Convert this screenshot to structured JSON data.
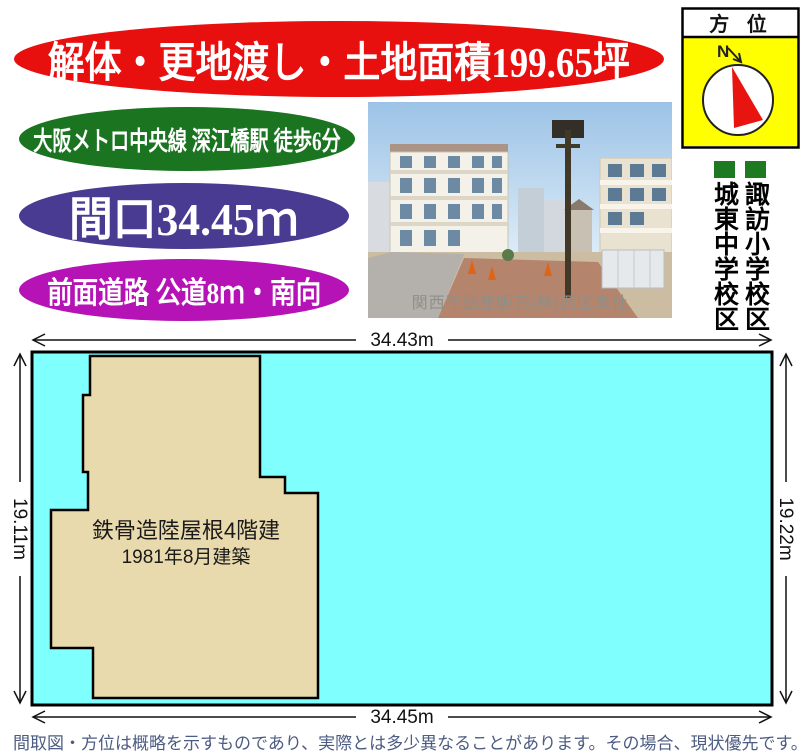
{
  "banners": {
    "main": {
      "label": "解体・更地渡し・土地面積199.65坪",
      "bg": "#e80f0f"
    },
    "access": {
      "label": "大阪メトロ中央線 深江橋駅 徒歩6分",
      "bg": "#1a7420"
    },
    "frontage": {
      "label": "間口34.45ｍ",
      "bg": "#483b91"
    },
    "road": {
      "label": "前面道路 公道8ｍ・南向",
      "bg": "#b513b5"
    }
  },
  "compass": {
    "title": "方 位",
    "north_label": "N",
    "bg": "#ffff00"
  },
  "schools": {
    "junior_high": {
      "label": "城東中学校区"
    },
    "elementary": {
      "label": "諏訪小学校区"
    },
    "color": "#1d7a22"
  },
  "photo": {
    "caption": "関西不動産販売(株)西区本社"
  },
  "plot": {
    "top_length": "34.43m",
    "bottom_length": "34.45m",
    "left_length": "19.11m",
    "right_length": "19.22m",
    "building": {
      "line1": "鉄骨造陸屋根4階建",
      "line2": "1981年8月建築"
    }
  },
  "disclaimer": "間取図・方位は概略を示すものであり、実際とは多少異なることがあります。その場合、現状優先です。",
  "colors": {
    "plot_fill": "#80ffff",
    "building_fill": "#e9daad",
    "compass_bg": "#ffff00",
    "school_green": "#1d7a22",
    "disclaimer_text": "#4d5c82",
    "caption_gray": "#8f8f88"
  }
}
